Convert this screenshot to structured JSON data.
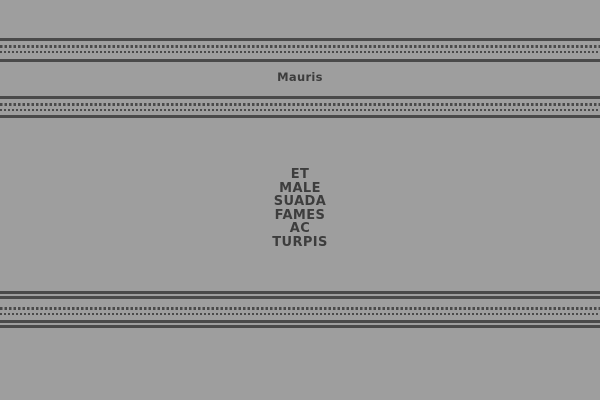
{
  "theme": {
    "background": "#9e9e9e",
    "line_color": "#4a4a4a",
    "text_color": "#3d3d3d"
  },
  "header": {
    "title": "Mauris"
  },
  "hero": {
    "lines": [
      "ET",
      "MALE",
      "SUADA",
      "FAMES",
      "AC",
      "TURPIS"
    ]
  }
}
